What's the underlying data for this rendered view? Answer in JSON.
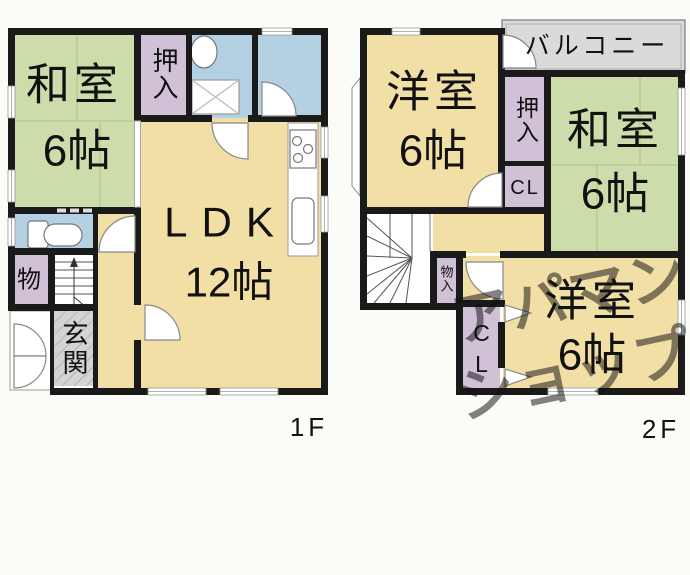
{
  "colors": {
    "tatami_room": "#cddcab",
    "western_room": "#f2dfa6",
    "wet_area": "#b3d1e3",
    "closet": "#d0c1d7",
    "entrance": "#d4d4d4",
    "balcony": "#dadada",
    "wall": "#1a1a1a"
  },
  "floor1": {
    "label": "1F",
    "washitsu": {
      "name": "和室",
      "size": "6帖"
    },
    "oshiire": "押入",
    "ldk": {
      "name": "LDK",
      "size": "12帖"
    },
    "mono": "物",
    "genkan": "玄関"
  },
  "floor2": {
    "label": "2F",
    "balcony": "バルコニー",
    "yoshitsu_top": {
      "name": "洋室",
      "size": "6帖"
    },
    "oshiire": "押入",
    "cl_upper": "CL",
    "washitsu": {
      "name": "和室",
      "size": "6帖"
    },
    "monoire": "物入",
    "cl_lower": "CL",
    "yoshitsu_bottom": {
      "name": "洋室",
      "size": "6帖"
    }
  },
  "watermark": {
    "line1": "アパマン",
    "line2": "ショップ",
    "color": "#e39a3e"
  }
}
